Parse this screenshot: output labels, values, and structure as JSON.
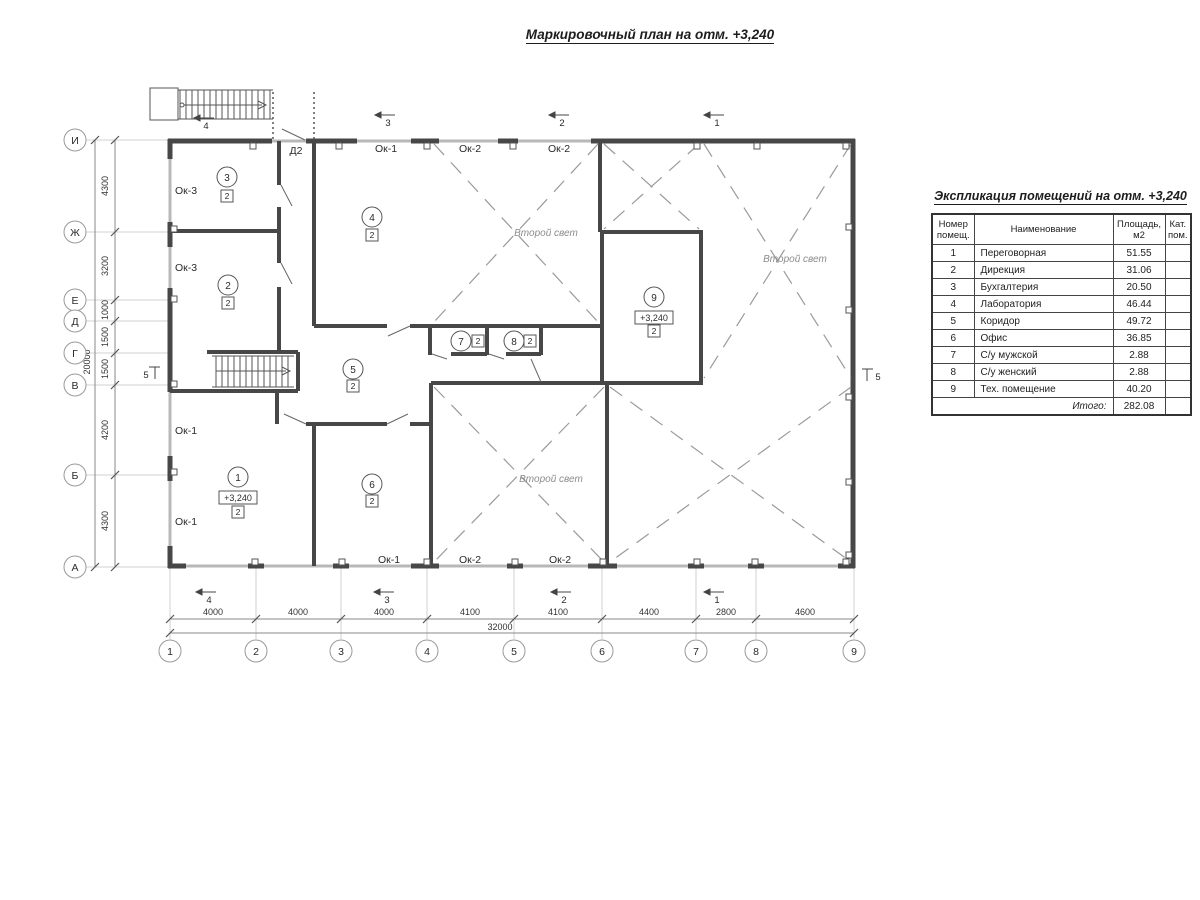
{
  "plan_title": "Маркировочный план на отм. +3,240",
  "axes": {
    "left": [
      "И",
      "Ж",
      "Е",
      "Д",
      "Г",
      "В",
      "Б",
      "А"
    ],
    "bottom": [
      "1",
      "2",
      "3",
      "4",
      "5",
      "6",
      "7",
      "8",
      "9"
    ]
  },
  "dims": {
    "left": [
      "4300",
      "3200",
      "1000",
      "1500",
      "1500",
      "4200",
      "4300"
    ],
    "left_total": "20000",
    "bottom": [
      "4000",
      "4000",
      "4000",
      "4100",
      "4100",
      "4400",
      "2800",
      "4600"
    ],
    "bottom_total": "32000"
  },
  "marks": {
    "s1": "1",
    "s2": "2",
    "s3": "3",
    "s4": "4",
    "s5": "5"
  },
  "labels": {
    "d2": "Д2",
    "ok1": "Ок-1",
    "ok2": "Ок-2",
    "ok3": "Ок-3",
    "second_light": "Второй свет",
    "level": "+3,240",
    "cat": "2",
    "r1": "1",
    "r2": "2",
    "r3": "3",
    "r4": "4",
    "r5": "5",
    "r6": "6",
    "r7": "7",
    "r8": "8",
    "r9": "9"
  },
  "table": {
    "title": "Экспликация помещений на отм. +3,240",
    "headers": {
      "num": "Номер помещ.",
      "name": "Наименование",
      "area": "Площадь, м2",
      "cat": "Кат. пом."
    },
    "rows": [
      {
        "num": "1",
        "name": "Переговорная",
        "area": "51.55",
        "cat": ""
      },
      {
        "num": "2",
        "name": "Дирекция",
        "area": "31.06",
        "cat": ""
      },
      {
        "num": "3",
        "name": "Бухгалтерия",
        "area": "20.50",
        "cat": ""
      },
      {
        "num": "4",
        "name": "Лаборатория",
        "area": "46.44",
        "cat": ""
      },
      {
        "num": "5",
        "name": "Коридор",
        "area": "49.72",
        "cat": ""
      },
      {
        "num": "6",
        "name": "Офис",
        "area": "36.85",
        "cat": ""
      },
      {
        "num": "7",
        "name": "С/у мужской",
        "area": "2.88",
        "cat": ""
      },
      {
        "num": "8",
        "name": "С/у женский",
        "area": "2.88",
        "cat": ""
      },
      {
        "num": "9",
        "name": "Тех. помещение",
        "area": "40.20",
        "cat": ""
      }
    ],
    "total_label": "Итого:",
    "total_value": "282.08"
  }
}
